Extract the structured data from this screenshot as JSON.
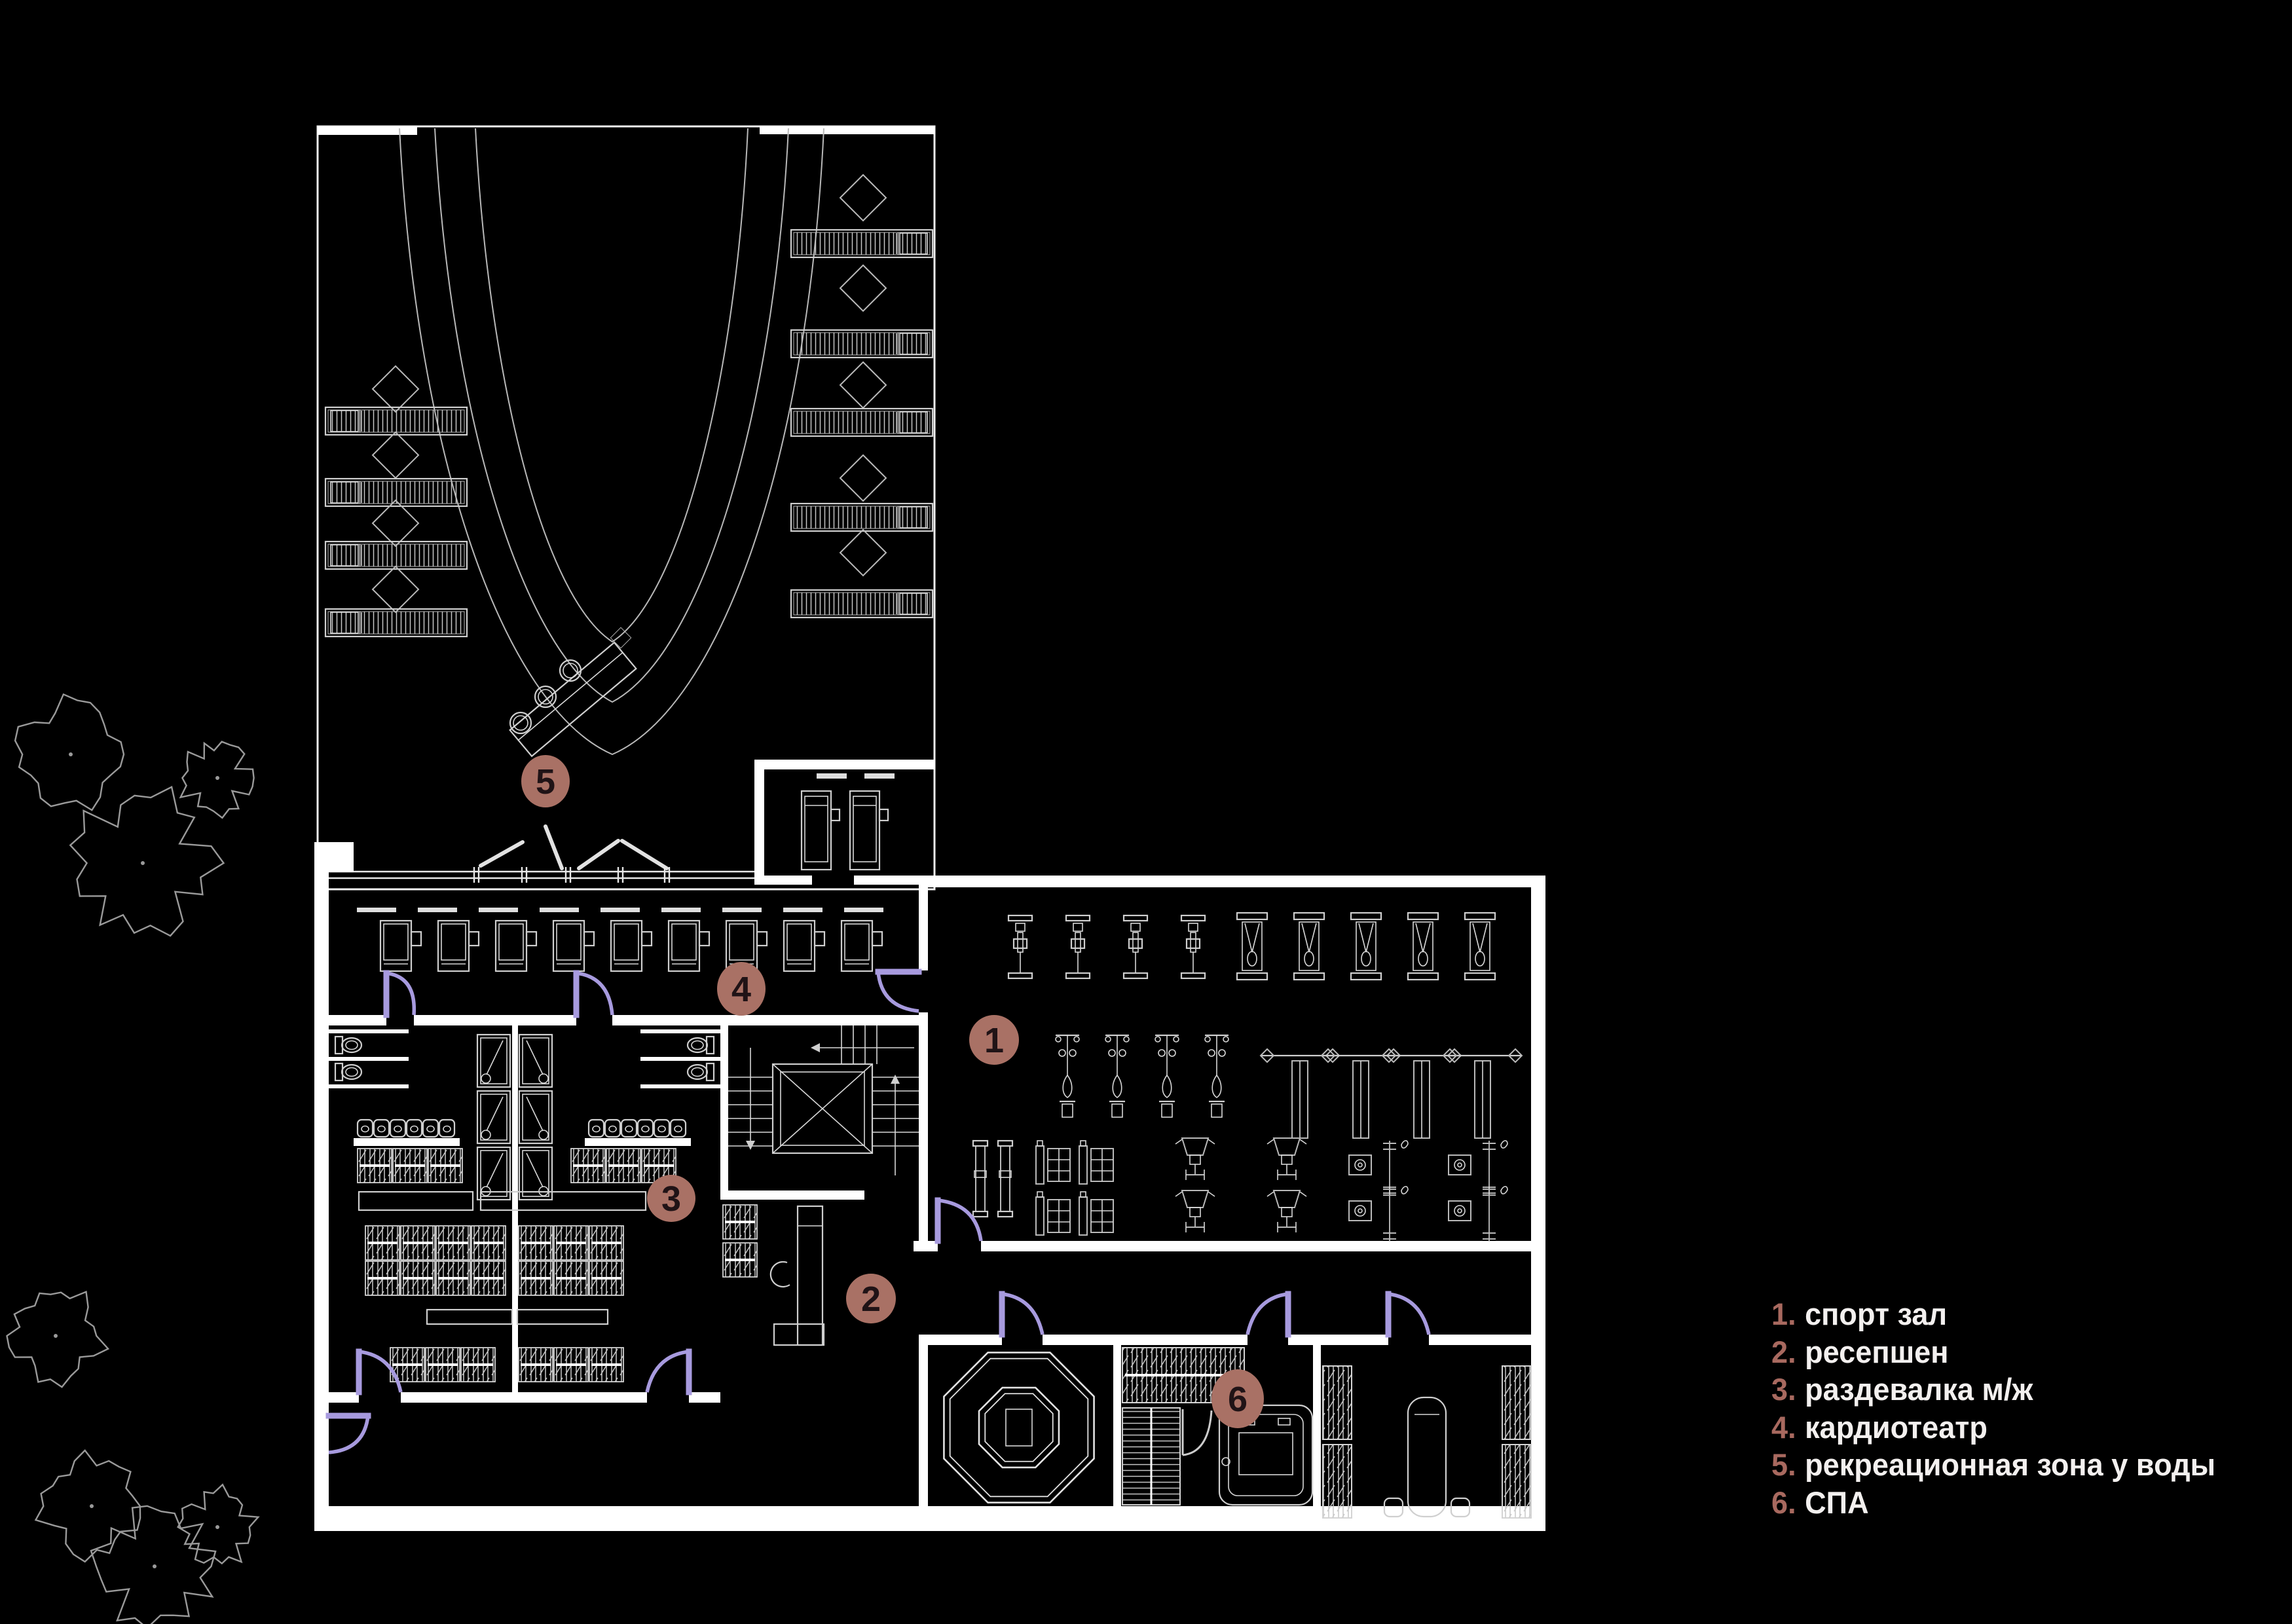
{
  "title": "fitness club floor plan",
  "legend": {
    "items": [
      {
        "num": "1.",
        "label": "спорт зал"
      },
      {
        "num": "2.",
        "label": "ресепшен"
      },
      {
        "num": "3.",
        "label": "раздевалка м/ж"
      },
      {
        "num": "4.",
        "label": "кардиотеатр"
      },
      {
        "num": "5.",
        "label": "рекреационная зона у воды"
      },
      {
        "num": "6.",
        "label": "СПА"
      }
    ]
  },
  "markers": [
    {
      "num": "1"
    },
    {
      "num": "2"
    },
    {
      "num": "3"
    },
    {
      "num": "4"
    },
    {
      "num": "5"
    },
    {
      "num": "6"
    }
  ],
  "theme": {
    "background": "#000000",
    "plan_line": "#cfcfcf",
    "wall": "#ffffff",
    "door": "#a79ade",
    "marker_fill": "#a97165",
    "marker_text": "#201316",
    "legend_number": "#a8695f",
    "legend_text": "#f3f0ef"
  }
}
